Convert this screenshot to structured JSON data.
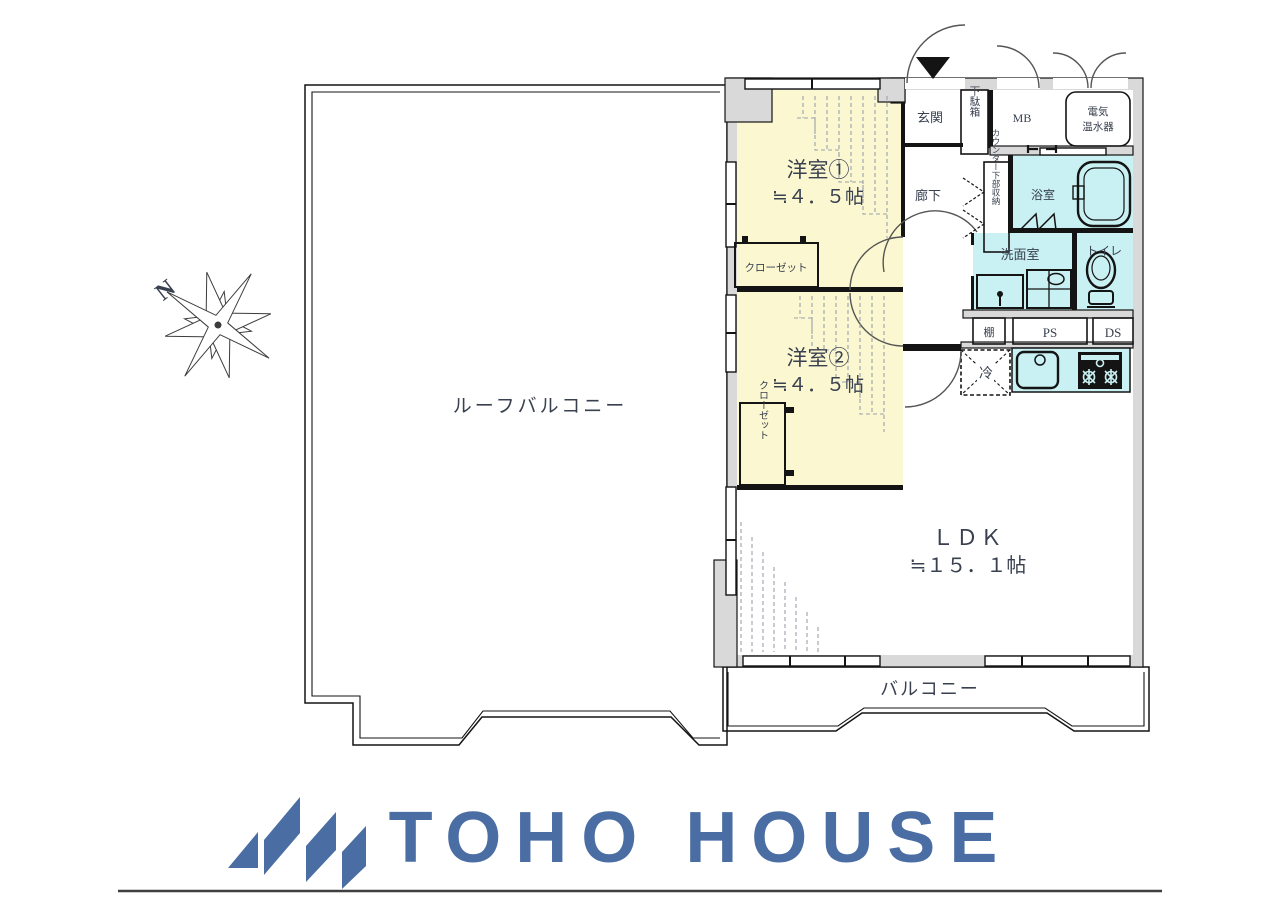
{
  "compass": {
    "north_label": "N"
  },
  "plan": {
    "roof_balcony": {
      "label": "ルーフバルコニー"
    },
    "balcony": {
      "label": "バルコニー"
    },
    "western_room_1": {
      "name": "洋室①",
      "size": "≒４．５帖",
      "closet_label": "クローゼット"
    },
    "western_room_2": {
      "name": "洋室②",
      "size": "≒４．５帖",
      "closet_label": "クローゼット"
    },
    "ldk": {
      "name": "ＬＤＫ",
      "size": "≒１５．１帖"
    },
    "entrance": {
      "label": "玄関"
    },
    "shoe_box": {
      "label": "下駄箱"
    },
    "hallway": {
      "label": "廊下"
    },
    "counter_storage": {
      "label": "カウンター下部収納"
    },
    "bathroom": {
      "label": "浴室"
    },
    "washroom": {
      "label": "洗面室"
    },
    "toilet": {
      "label": "トイレ"
    },
    "meter_box": {
      "label": "MB"
    },
    "water_heater": {
      "line1": "電気",
      "line2": "温水器"
    },
    "shelf": {
      "label": "棚"
    },
    "pipe_space": {
      "label": "PS"
    },
    "duct_space": {
      "label": "DS"
    },
    "refrigerator": {
      "label": "冷"
    }
  },
  "branding": {
    "company": "TOHO HOUSE",
    "accent_color": "#4A6DA4"
  },
  "palette": {
    "room_yellow": "#FBF7D0",
    "wet_area_cyan": "#C9F0F2",
    "storage_orange": "#F6C691",
    "closet_orange": "#F2A97D",
    "wall_gray": "#D9D9D9",
    "line_black": "#141414",
    "label_navy": "#39404F"
  }
}
